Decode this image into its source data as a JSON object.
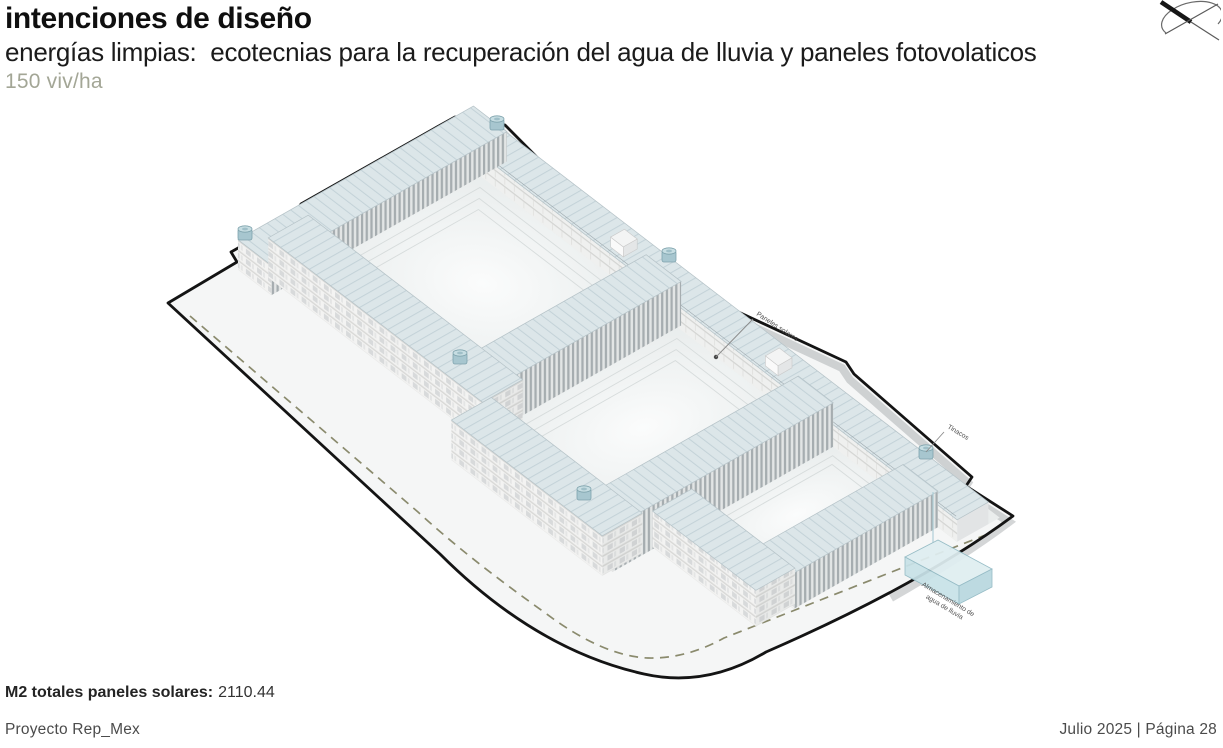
{
  "header": {
    "title": "intenciones de diseño",
    "subtitle": "energías limpias:  ecotecnias para la recuperación del agua de lluvia y paneles fotovolaticos",
    "density": "150 viv/ha"
  },
  "diagram": {
    "labels": {
      "solar_panels": "Paneles solares",
      "water_tanks": "Tinacos",
      "rain_storage_line1": "Almacenamiento de",
      "rain_storage_line2": "agua de lluvia"
    }
  },
  "stats": {
    "label": "M2 totales paneles solares:",
    "value": "2110.44"
  },
  "footer": {
    "project": "Proyecto Rep_Mex",
    "date_page": "Julio 2025 | Página 28"
  },
  "colors": {
    "accent_sage": "#a3a696",
    "boundary": "#141414",
    "roof": "#dce6e9",
    "dashed_line": "#8a8a6d",
    "water_feature": "#cfe6ec"
  }
}
